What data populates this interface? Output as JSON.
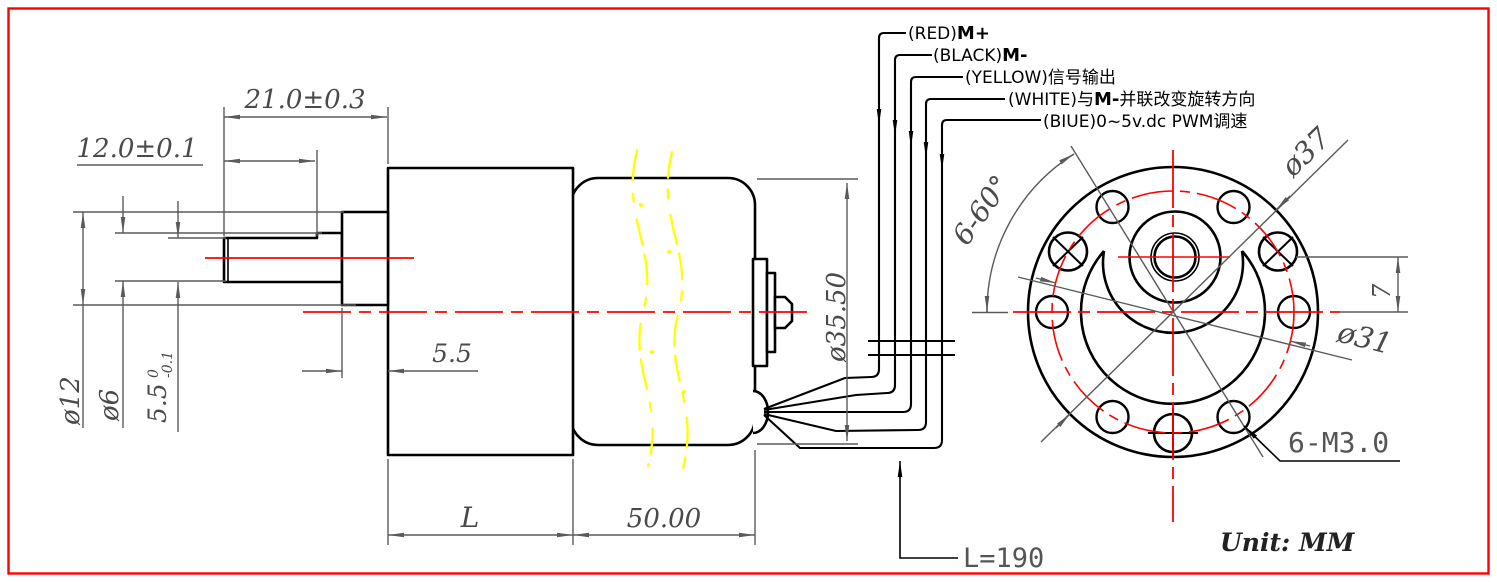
{
  "colors": {
    "outline": "#000000",
    "dimension": "#5a5a5a",
    "centerline": "#ff0000",
    "frame": "#ff0000",
    "break_line": "#ffff00"
  },
  "side_view": {
    "dims": {
      "shaft_length": "21.0±0.3",
      "flat_length": "12.0±0.1",
      "boss_diameter": "ø12",
      "shaft_diameter": "ø6",
      "flat_height": "5.5",
      "flat_height_tol_upper": "0",
      "flat_height_tol_lower": "-0.1",
      "boss_width": "5.5",
      "gearbox_length": "L",
      "motor_length": "50.00",
      "motor_diameter": "ø35.50"
    }
  },
  "front_view": {
    "dims": {
      "hole_spacing_angle": "6-60°",
      "outer_diameter": "ø37",
      "bolt_circle_diameter": "ø31",
      "shaft_offset": "7",
      "mounting_holes": "6-M3.0"
    }
  },
  "wires": {
    "labels": [
      {
        "pre": "(RED)",
        "bold": "M+",
        "post": ""
      },
      {
        "pre": "(BLACK)",
        "bold": "M-",
        "post": ""
      },
      {
        "pre": "(YELLOW)",
        "bold": "",
        "post": "信号输出"
      },
      {
        "pre": "(WHITE)与",
        "bold": "M-",
        "post": "并联改变旋转方向"
      },
      {
        "pre": "(BIUE)",
        "bold": "",
        "post": "0~5v.dc PWM调速"
      }
    ]
  },
  "notes": {
    "total_length": "L=190",
    "unit": "Unit: MM"
  }
}
